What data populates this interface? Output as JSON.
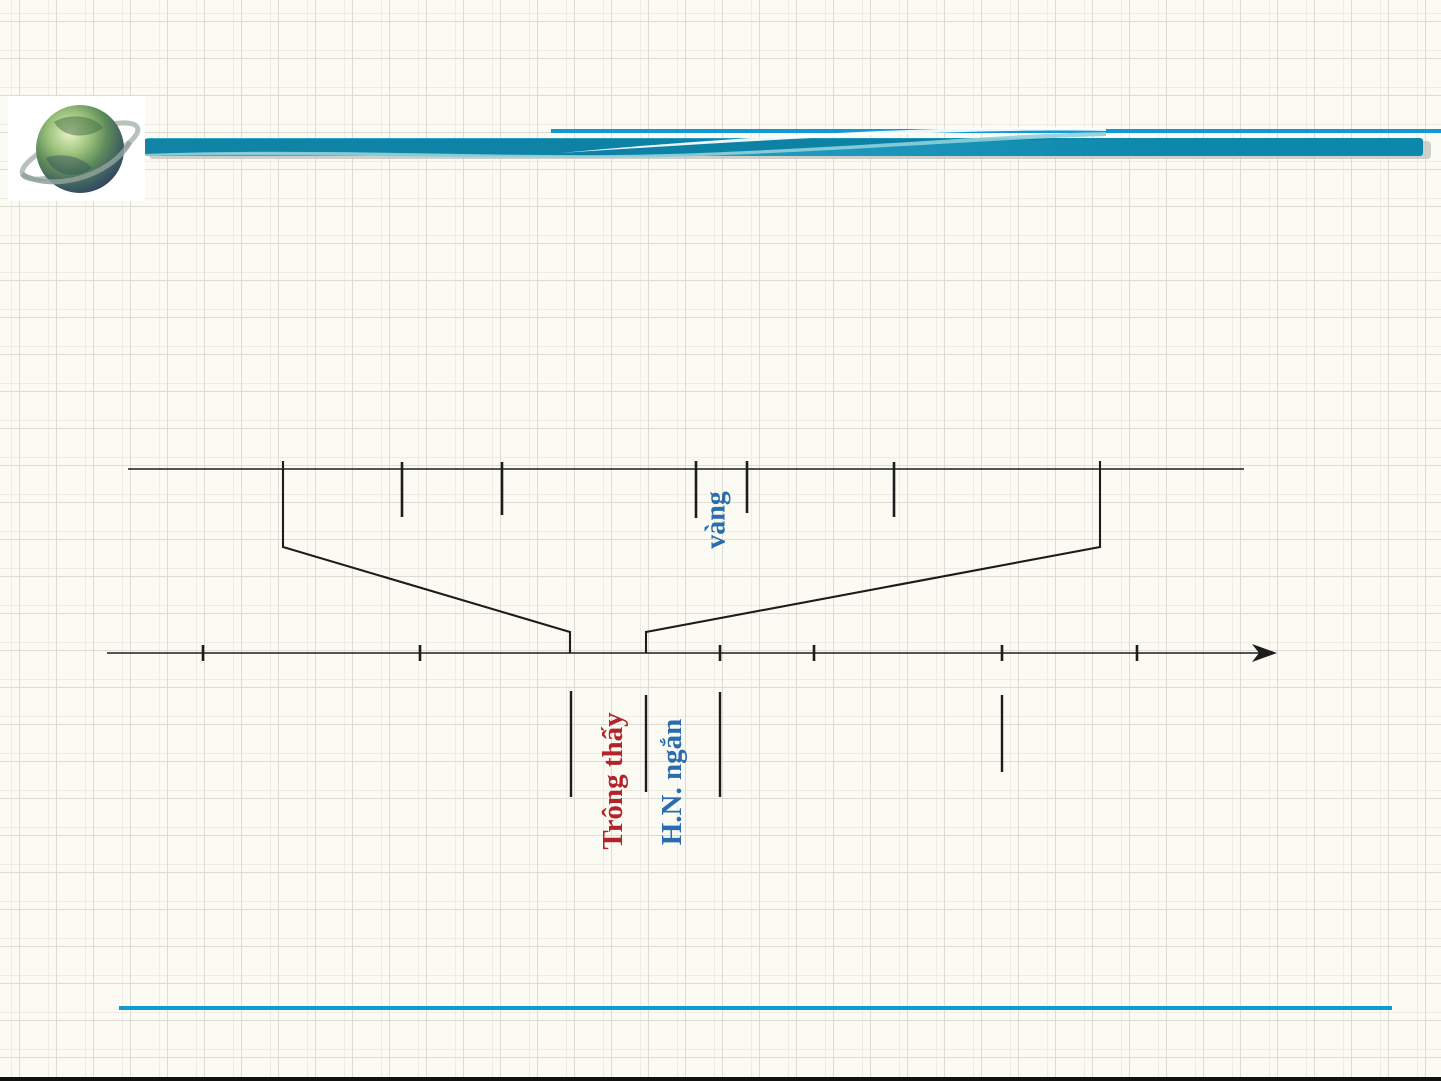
{
  "slide": {
    "kind": "presentation-slide-spectrum-diagram",
    "theme": {
      "background": "#FBFBF3",
      "grid_line": "#DCDCD4",
      "grid_line_faint": "#EDEDE5",
      "ink": "#1C1C1C",
      "accent_blue": "#1099D6",
      "band_teal_dark": "#0E87AC",
      "band_teal_mid": "#36A7C7",
      "band_highlight": "#8FD0DC"
    },
    "header": {
      "thin_rule": {
        "x1": 551,
        "x2": 1441,
        "y": 129,
        "h": 4
      },
      "band": {
        "x1": 145,
        "x2": 1423,
        "y": 138,
        "h": 18
      },
      "logo": {
        "name": "globe-logo",
        "x": 8,
        "y": 96,
        "w": 137,
        "h": 105
      }
    },
    "footer": {
      "rule_blue": {
        "x1": 119,
        "x2": 1392,
        "y": 1006,
        "h": 4,
        "color": "#1099D6"
      },
      "edge_dark": {
        "y": 1077,
        "h": 4,
        "color": "#101010"
      }
    }
  },
  "diagram": {
    "description": "zoomed wavelength scale funneling down onto a spectrum axis",
    "upper_line": {
      "x1": 128,
      "x2": 1244,
      "y": 469
    },
    "upper_ticks": [
      {
        "x": 402,
        "y1": 462,
        "y2": 517
      },
      {
        "x": 502,
        "y1": 462,
        "y2": 515
      },
      {
        "x": 696,
        "y1": 461,
        "y2": 518
      },
      {
        "x": 747,
        "y1": 461,
        "y2": 513
      },
      {
        "x": 894,
        "y1": 462,
        "y2": 517
      }
    ],
    "brackets": [
      {
        "points": "283,461 283,547 570,632 570,653"
      },
      {
        "points": "1100,461 1100,547 646,632 646,653"
      }
    ],
    "axis": {
      "x1": 107,
      "x2": 1261,
      "y": 653,
      "arrow_tip_x": 1277
    },
    "axis_ticks": [
      {
        "x": 203,
        "y1": 645,
        "y2": 661
      },
      {
        "x": 420,
        "y1": 645,
        "y2": 661
      },
      {
        "x": 720,
        "y1": 645,
        "y2": 661
      },
      {
        "x": 814,
        "y1": 645,
        "y2": 661
      },
      {
        "x": 1002,
        "y1": 645,
        "y2": 661
      },
      {
        "x": 1137,
        "y1": 645,
        "y2": 661
      }
    ],
    "leaders": [
      {
        "x": 571,
        "y1": 691,
        "y2": 797
      },
      {
        "x": 646,
        "y1": 695,
        "y2": 792
      },
      {
        "x": 720,
        "y1": 692,
        "y2": 797
      },
      {
        "x": 1002,
        "y1": 695,
        "y2": 772
      }
    ],
    "labels": [
      {
        "text": "vàng",
        "color": "#2A6CAE",
        "cx": 716,
        "cy": 520,
        "size": 28
      },
      {
        "text": "Trông thấy",
        "color": "#B2242A",
        "cx": 613,
        "cy": 781,
        "size": 29
      },
      {
        "text": "H.N. ngắn",
        "color": "#2A6CAE",
        "cx": 672,
        "cy": 782,
        "size": 29
      }
    ]
  }
}
